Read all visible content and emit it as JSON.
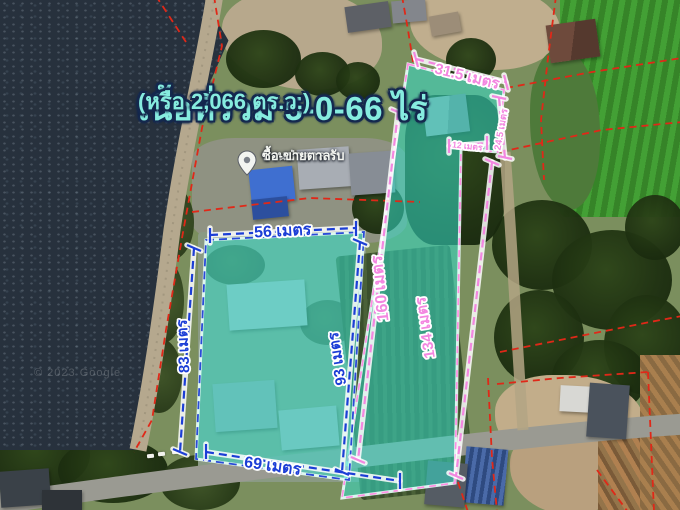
{
  "map": {
    "title": "เนื้อที่รวม 5-0-66 ไร่",
    "subtitle": "(หรือ 2,066 ตร.ว.)",
    "watermark": "© 2023 Google",
    "place_label": {
      "line1": "บ้านป่าตาล รับ",
      "line2": "ซื้อ-ขายตาล"
    },
    "measurements": {
      "outer_top": "31.5 เมตร",
      "notch_height": "24.5 เมตร",
      "notch_width": "12 เมตร",
      "strip_left": "160 เมตร",
      "strip_right": "134 เมตร",
      "inner_right": "93 เมตร",
      "inner_top": "56 เมตร",
      "inner_left": "83 เมตร",
      "inner_bottom": "69 เมตร"
    },
    "colors": {
      "parcel_fill_teal": "#35dcc8",
      "parcel_border": "#eafffb",
      "dimension_blue": "#1c3ed6",
      "dimension_pink": "#f387e0",
      "cadastral_red": "#e02818",
      "title_fill": "#86ecdf",
      "title_outline": "#14284e",
      "water": "#27313d"
    }
  }
}
